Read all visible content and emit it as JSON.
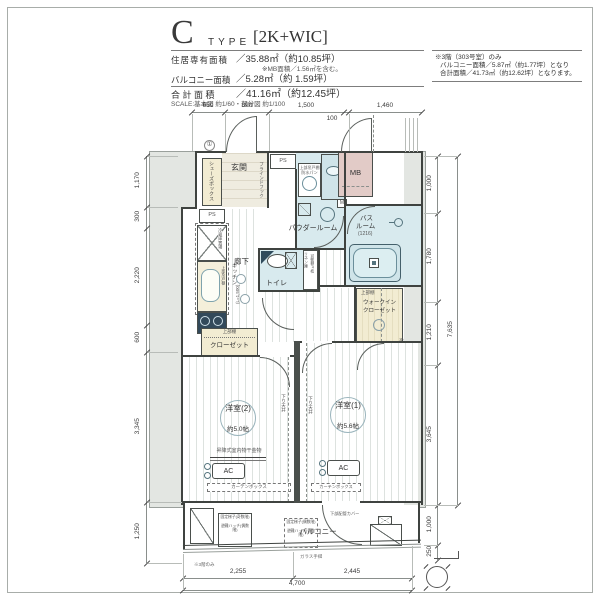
{
  "header": {
    "type_letter": "C",
    "type_word": "TYPE",
    "type_spec": "[2K+WIC]",
    "line1_label": "住居専有面積",
    "line1_value": "／35.88㎡（約10.85坪）",
    "mb_note": "※MB面積／1.56㎡を含む。",
    "line2_label": "バルコニー面積",
    "line2_value": "／5.28㎡（約 1.59坪）",
    "line3_label": "合 計 面 積",
    "line3_value": "／41.16㎡（約12.45坪）",
    "scale_note": "SCALE:基本図 約1/60・部分図 約1/100",
    "side_note1": "※3階（303号室）のみ",
    "side_note2": "バルコニー面積／5.87㎡（約1.77坪）となり",
    "side_note3": "合計面積／41.73㎡（約12.62坪）となります。"
  },
  "rooms": {
    "genkan": "玄関",
    "shoes_box": "シューズボックス",
    "powder": "パウダールーム",
    "toilet": "トイレ",
    "bath_line1": "バス",
    "bath_line2": "ルーム",
    "bath_size": "(1216)",
    "mb": "MB",
    "hall": "廊下",
    "kitchen": "キッチン",
    "kitchen_len": "(L=1,500)",
    "closet": "クローゼット",
    "wic_line1": "ウォークイン",
    "wic_line2": "クローゼット",
    "room2": "洋室(2)",
    "room2_size": "約5.0帖",
    "room1": "洋室(1)",
    "room1_size": "約5.6帖",
    "balcony": "バルコニー"
  },
  "fixtures": {
    "ps": "PS",
    "m": "M",
    "mark1": "①",
    "upper_shelf": "上部棚",
    "upper_cabinet": "上部吊戸棚",
    "waterproof_pan": "防水パン",
    "fridge": "冷蔵庫置場",
    "linen": "リネン庫",
    "movable": "可動棚4枚",
    "hook": "ブラインドフック",
    "drying": "昇降式室内物干金物",
    "ac": "AC",
    "curtain_box": "カーテンボックス",
    "down_ceiling": "下り天井",
    "beam_note": "梁型(4〜15階のみ)",
    "ladder_odd": "固定梯子(奇数階)",
    "hatch_even": "避難ハッチ(偶数階)",
    "ladder_even": "固定梯子(偶数階)",
    "hatch_odd": "避難ハッチ(奇数階)",
    "pipe_cover": "下部配管カバー",
    "glass_rail": "ガラス手摺",
    "floor3_note": "※3階のみ"
  },
  "dims": {
    "top": [
      "650",
      "890",
      "1,500",
      "100",
      "1,460"
    ],
    "left": [
      "1,170",
      "300",
      "2,220",
      "600",
      "3,345",
      "1,250"
    ],
    "right": [
      "1,000",
      "1,780",
      "1,210",
      "3,645"
    ],
    "right_total": "7,635",
    "right_b1": "1,000",
    "right_b2": "250",
    "bottom": [
      "2,255",
      "2,445"
    ],
    "bottom_total": "4,700"
  },
  "colors": {
    "wet_area": "#d8eaee",
    "storage_cream": "#f2ecd2",
    "mb_pink": "#e2cbc7",
    "slab_gray": "#e3e6e2"
  }
}
